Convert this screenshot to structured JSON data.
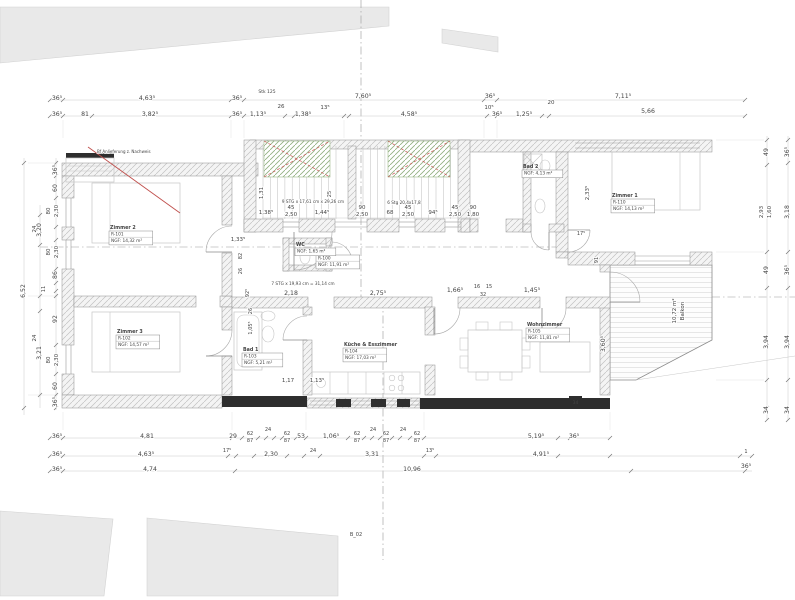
{
  "drawing": {
    "title": "Grundriss Wohnung (Floor plan)",
    "colors": {
      "annotation_red": "#c0504d",
      "stair_hatch_green": "#8fae7e",
      "wall_black": "#2e2e2e"
    },
    "window_tag": "34",
    "section_marks": {
      "stair_note": "Stk 125",
      "section_label": "B_02"
    },
    "red_note": "Bf Anlieferung z. Nachweis",
    "balcony": {
      "area": "10,72 m²",
      "name": "Balkon"
    },
    "stair_texts": {
      "upper_flight": "9 STG x 17,61 cm x 29,26 cm",
      "upper_flight_green": "6 Stg 20,4x17,8",
      "lower_flight": "7 STG x 19,93 cm = 31,14 cm"
    },
    "rooms": [
      {
        "name": "Zimmer 2",
        "lines": [
          "R-101",
          "NGF: 14,32 m²"
        ],
        "x": 110,
        "y": 229
      },
      {
        "name": "Zimmer 3",
        "lines": [
          "R-102",
          "NGF: 14,57 m²"
        ],
        "x": 117,
        "y": 333
      },
      {
        "name": "Bad 1",
        "lines": [
          "R-103",
          "NGF: 5,21 m²"
        ],
        "x": 243,
        "y": 351
      },
      {
        "name": "Küche & Esszimmer",
        "lines": [
          "R-104",
          "NGF: 17,03 m²"
        ],
        "x": 344,
        "y": 346
      },
      {
        "name": "Wohnzimmer",
        "lines": [
          "R-105",
          "NGF: 11,81 m²"
        ],
        "x": 527,
        "y": 326
      },
      {
        "name": "Flur",
        "lines": [
          "R-100",
          "NGF: 11,91 m²"
        ],
        "x": 317,
        "y": 253
      },
      {
        "name": "Zimmer 1",
        "lines": [
          "R-110",
          "NGF: 14,13 m²"
        ],
        "x": 612,
        "y": 197
      },
      {
        "name": "WC",
        "lines": [
          "NGF: 1,65 m²"
        ],
        "x": 296,
        "y": 246
      },
      {
        "name": "Bad 2",
        "lines": [
          "NGF: 4,13 m²"
        ],
        "x": 523,
        "y": 168
      }
    ],
    "labels": [
      {
        "t": "Stk 125",
        "x": 267,
        "y": 93,
        "s": 4.5,
        "c": "#999999"
      },
      {
        "t": "36⁵",
        "x": 57,
        "y": 100
      },
      {
        "t": "4,63⁵",
        "x": 147,
        "y": 100
      },
      {
        "t": "36⁵",
        "x": 237,
        "y": 100
      },
      {
        "t": "7,60⁵",
        "x": 363,
        "y": 98
      },
      {
        "t": "36⁵",
        "x": 490,
        "y": 98
      },
      {
        "t": "7,11⁵",
        "x": 623,
        "y": 98
      },
      {
        "t": "36⁵",
        "x": 57,
        "y": 116
      },
      {
        "t": "81",
        "x": 85,
        "y": 116
      },
      {
        "t": "3,82⁵",
        "x": 150,
        "y": 116
      },
      {
        "t": "36⁵",
        "x": 237,
        "y": 116
      },
      {
        "t": "1,13⁵",
        "x": 258,
        "y": 116
      },
      {
        "t": "26",
        "x": 281,
        "y": 108,
        "s": 5.5
      },
      {
        "t": "1,38⁵",
        "x": 303,
        "y": 116
      },
      {
        "t": "13⁵",
        "x": 325,
        "y": 109,
        "s": 5.5
      },
      {
        "t": "4,58⁵",
        "x": 409,
        "y": 116
      },
      {
        "t": "10⁵",
        "x": 489,
        "y": 109,
        "s": 5.5
      },
      {
        "t": "36⁵",
        "x": 497,
        "y": 116
      },
      {
        "t": "1,25⁵",
        "x": 524,
        "y": 116
      },
      {
        "t": "20",
        "x": 551,
        "y": 104,
        "s": 5.5
      },
      {
        "t": "5,66",
        "x": 648,
        "y": 113
      },
      {
        "t": "36⁵",
        "x": 57,
        "y": 438
      },
      {
        "t": "4,81",
        "x": 147,
        "y": 438
      },
      {
        "t": "29",
        "x": 233,
        "y": 438
      },
      {
        "t": "62",
        "x": 250,
        "y": 435,
        "s": 5
      },
      {
        "t": "87",
        "x": 250,
        "y": 442,
        "s": 5
      },
      {
        "t": "24",
        "x": 268,
        "y": 431,
        "s": 5
      },
      {
        "t": "62",
        "x": 287,
        "y": 435,
        "s": 5
      },
      {
        "t": "87",
        "x": 287,
        "y": 442,
        "s": 5
      },
      {
        "t": "53",
        "x": 301,
        "y": 438
      },
      {
        "t": "1,06⁵",
        "x": 331,
        "y": 438
      },
      {
        "t": "62",
        "x": 357,
        "y": 435,
        "s": 5
      },
      {
        "t": "87",
        "x": 357,
        "y": 442,
        "s": 5
      },
      {
        "t": "24",
        "x": 373,
        "y": 431,
        "s": 5
      },
      {
        "t": "62",
        "x": 386,
        "y": 435,
        "s": 5
      },
      {
        "t": "87",
        "x": 386,
        "y": 442,
        "s": 5
      },
      {
        "t": "24",
        "x": 403,
        "y": 431,
        "s": 5
      },
      {
        "t": "62",
        "x": 417,
        "y": 435,
        "s": 5
      },
      {
        "t": "87",
        "x": 417,
        "y": 442,
        "s": 5
      },
      {
        "t": "5,19⁵",
        "x": 536,
        "y": 438
      },
      {
        "t": "36⁵",
        "x": 574,
        "y": 438
      },
      {
        "t": "36⁵",
        "x": 57,
        "y": 456
      },
      {
        "t": "4,63⁵",
        "x": 146,
        "y": 456
      },
      {
        "t": "17⁵",
        "x": 227,
        "y": 452,
        "s": 5
      },
      {
        "t": "2,30",
        "x": 271,
        "y": 456
      },
      {
        "t": "24",
        "x": 313,
        "y": 452,
        "s": 5
      },
      {
        "t": "3,31",
        "x": 372,
        "y": 456
      },
      {
        "t": "13⁵",
        "x": 430,
        "y": 452,
        "s": 5
      },
      {
        "t": "4,91⁵",
        "x": 541,
        "y": 456
      },
      {
        "t": "1",
        "x": 746,
        "y": 453,
        "s": 5
      },
      {
        "t": "36⁵",
        "x": 57,
        "y": 471
      },
      {
        "t": "4,74",
        "x": 150,
        "y": 471
      },
      {
        "t": "10,96",
        "x": 412,
        "y": 471
      },
      {
        "t": "36⁵",
        "x": 746,
        "y": 468
      },
      {
        "t": "36⁵",
        "x": 57,
        "y": 170,
        "r": -90
      },
      {
        "t": "60",
        "x": 57,
        "y": 188,
        "r": -90
      },
      {
        "t": "80",
        "x": 50,
        "y": 211,
        "r": -90,
        "s": 5.5
      },
      {
        "t": "2,30",
        "x": 58,
        "y": 211,
        "r": -90,
        "s": 5.5
      },
      {
        "t": "24",
        "x": 36,
        "y": 229,
        "r": -90,
        "s": 5.5
      },
      {
        "t": "80",
        "x": 50,
        "y": 252,
        "r": -90,
        "s": 5.5
      },
      {
        "t": "2,30",
        "x": 58,
        "y": 252,
        "r": -90,
        "s": 5.5
      },
      {
        "t": "86",
        "x": 57,
        "y": 275,
        "r": -90
      },
      {
        "t": "11",
        "x": 45,
        "y": 289,
        "r": -90,
        "s": 5
      },
      {
        "t": "3,20",
        "x": 41,
        "y": 230,
        "r": -90
      },
      {
        "t": "6,52",
        "x": 25,
        "y": 291,
        "r": -90
      },
      {
        "t": "92",
        "x": 57,
        "y": 319,
        "r": -90
      },
      {
        "t": "3,21",
        "x": 41,
        "y": 353,
        "r": -90
      },
      {
        "t": "24",
        "x": 36,
        "y": 338,
        "r": -90,
        "s": 5.5
      },
      {
        "t": "80",
        "x": 50,
        "y": 360,
        "r": -90,
        "s": 5.5
      },
      {
        "t": "2,30",
        "x": 58,
        "y": 360,
        "r": -90,
        "s": 5.5
      },
      {
        "t": "60",
        "x": 57,
        "y": 386,
        "r": -90
      },
      {
        "t": "36⁵",
        "x": 57,
        "y": 402,
        "r": -90
      },
      {
        "t": "49",
        "x": 768,
        "y": 152,
        "r": -90
      },
      {
        "t": "2,93",
        "x": 763,
        "y": 212,
        "r": -90,
        "s": 5.5
      },
      {
        "t": "1,60",
        "x": 771,
        "y": 212,
        "r": -90,
        "s": 5.5
      },
      {
        "t": "49",
        "x": 768,
        "y": 270,
        "r": -90
      },
      {
        "t": "3,94",
        "x": 768,
        "y": 342,
        "r": -90
      },
      {
        "t": "34",
        "x": 768,
        "y": 410,
        "r": -90
      },
      {
        "t": "36⁵",
        "x": 789,
        "y": 152,
        "r": -90
      },
      {
        "t": "3,18",
        "x": 789,
        "y": 212,
        "r": -90
      },
      {
        "t": "36⁵",
        "x": 789,
        "y": 270,
        "r": -90
      },
      {
        "t": "3,94",
        "x": 789,
        "y": 342,
        "r": -90
      },
      {
        "t": "34",
        "x": 789,
        "y": 410,
        "r": -90
      },
      {
        "t": "1,31",
        "x": 263,
        "y": 193,
        "r": -90,
        "s": 5.5
      },
      {
        "t": "1,38⁵",
        "x": 266,
        "y": 214,
        "s": 5.5
      },
      {
        "t": "45",
        "x": 291,
        "y": 209,
        "s": 5.5
      },
      {
        "t": "2,50",
        "x": 291,
        "y": 216,
        "s": 5.5
      },
      {
        "t": "1,44⁵",
        "x": 322,
        "y": 214,
        "s": 5.5
      },
      {
        "t": "90",
        "x": 362,
        "y": 209,
        "s": 5.5
      },
      {
        "t": "2,50",
        "x": 362,
        "y": 216,
        "s": 5.5
      },
      {
        "t": "68",
        "x": 390,
        "y": 214,
        "s": 5.5
      },
      {
        "t": "45",
        "x": 408,
        "y": 209,
        "s": 5.5
      },
      {
        "t": "2,50",
        "x": 408,
        "y": 216,
        "s": 5.5
      },
      {
        "t": "94⁵",
        "x": 433,
        "y": 214,
        "s": 5.5
      },
      {
        "t": "45",
        "x": 455,
        "y": 209,
        "s": 5.5
      },
      {
        "t": "2,50",
        "x": 455,
        "y": 216,
        "s": 5.5
      },
      {
        "t": "90",
        "x": 473,
        "y": 209,
        "s": 5.5
      },
      {
        "t": "1,80",
        "x": 473,
        "y": 216,
        "s": 5.5
      },
      {
        "t": "25",
        "x": 331,
        "y": 194,
        "r": -90,
        "s": 5
      },
      {
        "t": "9 STG x 17,61 cm x 29,26 cm",
        "x": 313,
        "y": 203,
        "s": 4.2
      },
      {
        "t": "6 Stg 20,4x17,8",
        "x": 404,
        "y": 204,
        "s": 4.2,
        "c": "#6b8f5e"
      },
      {
        "t": "7 STG x 19,93 cm = 31,14 cm",
        "x": 303,
        "y": 285,
        "s": 4.2
      },
      {
        "t": "2,18",
        "x": 291,
        "y": 295
      },
      {
        "t": "2,75⁵",
        "x": 378,
        "y": 295
      },
      {
        "t": "1,66⁵",
        "x": 455,
        "y": 292
      },
      {
        "t": "16",
        "x": 477,
        "y": 288,
        "s": 5
      },
      {
        "t": "15",
        "x": 489,
        "y": 288,
        "s": 5
      },
      {
        "t": "32",
        "x": 483,
        "y": 296,
        "s": 5
      },
      {
        "t": "1,45⁵",
        "x": 532,
        "y": 292
      },
      {
        "t": "1,33⁵",
        "x": 238,
        "y": 241,
        "s": 5.5
      },
      {
        "t": "82",
        "x": 242,
        "y": 256,
        "r": -90,
        "s": 5
      },
      {
        "t": "26",
        "x": 242,
        "y": 271,
        "r": -90,
        "s": 5
      },
      {
        "t": "92⁵",
        "x": 249,
        "y": 293,
        "r": -90,
        "s": 5
      },
      {
        "t": "26",
        "x": 252,
        "y": 311,
        "r": -90,
        "s": 5
      },
      {
        "t": "1,05⁵",
        "x": 252,
        "y": 328,
        "r": -90,
        "s": 5
      },
      {
        "t": "1,17",
        "x": 288,
        "y": 382,
        "s": 5.5
      },
      {
        "t": "1,13⁵",
        "x": 317,
        "y": 382,
        "s": 5.5
      },
      {
        "t": "2,33⁵",
        "x": 589,
        "y": 193,
        "r": -90,
        "s": 5.5
      },
      {
        "t": "17⁵",
        "x": 581,
        "y": 235,
        "s": 5
      },
      {
        "t": "91",
        "x": 598,
        "y": 260,
        "r": -90,
        "s": 5
      },
      {
        "t": "3,60⁵",
        "x": 605,
        "y": 344,
        "r": -90
      },
      {
        "t": "10,72 m²",
        "x": 676,
        "y": 311,
        "r": -90,
        "s": 5.5
      },
      {
        "t": "Balkon",
        "x": 684,
        "y": 311,
        "r": -90,
        "s": 5.5
      },
      {
        "t": "B_02",
        "x": 356,
        "y": 536,
        "s": 5,
        "c": "#999999"
      },
      {
        "t": "34",
        "x": 575.5,
        "y": 404,
        "s": 4.5,
        "c": "#ffffff"
      },
      {
        "t": "Bf Anlieferung z. Nachweis",
        "x": 97,
        "y": 153,
        "s": 4,
        "c": "#c0504d",
        "a": "start"
      }
    ]
  }
}
